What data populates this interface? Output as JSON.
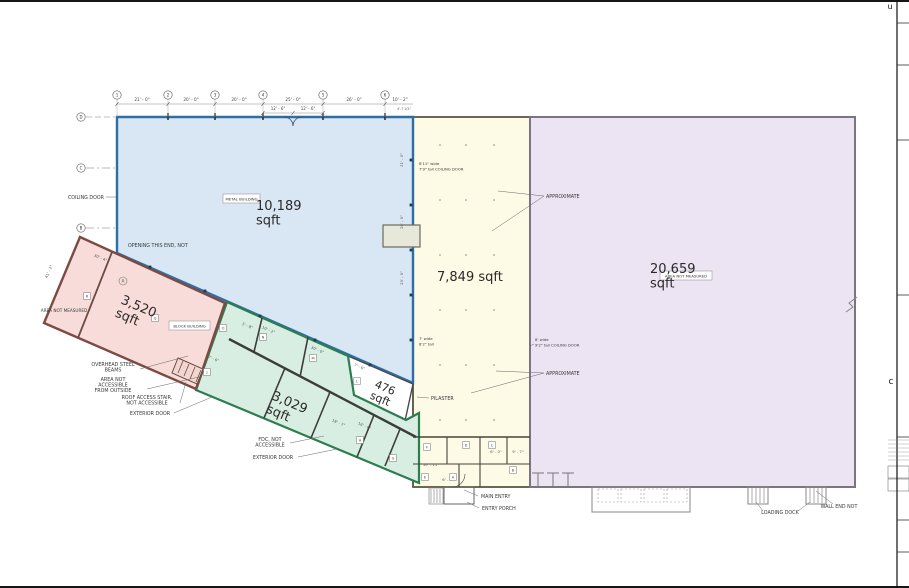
{
  "page": {
    "width": 909,
    "height": 588,
    "bg": "#ffffff",
    "border_color": "#161616"
  },
  "sheet_frame": {
    "line_x": 897,
    "ticks_y": [
      23,
      65,
      140,
      295,
      437,
      520,
      552
    ],
    "table_lines_y": [
      440,
      444,
      448,
      452,
      456,
      460
    ],
    "edge_letter_top": {
      "text": "u",
      "x": 890,
      "y": 9
    },
    "edge_letter_mid": {
      "text": "c",
      "x": 891,
      "y": 384
    }
  },
  "regions": [
    {
      "id": "warehouse-7849",
      "points": "413,117 530,117 530,487 413,487",
      "fill": "#fdfae6",
      "stroke": "#55543f",
      "sw": 1.8,
      "label": {
        "lines": [
          "7,849  sqft"
        ],
        "x": 437,
        "y": 281,
        "fs": 13,
        "r": 0,
        "a": "start"
      }
    },
    {
      "id": "warehouse-20659",
      "points": "530,117 855,117 855,487 530,487",
      "fill": "#ece3f3",
      "stroke": "#7a7580",
      "sw": 2,
      "label": {
        "lines": [
          "20,659",
          "sqft"
        ],
        "x": 650,
        "y": 273,
        "fs": 13,
        "r": 0,
        "a": "start"
      }
    },
    {
      "id": "metal-building-10189",
      "points": "117,117 413,117 413,383 117,253",
      "fill": "#d9e6f4",
      "stroke": "#2e6ea6",
      "sw": 2.4,
      "label": {
        "lines": [
          "10,189",
          "sqft"
        ],
        "x": 256,
        "y": 210,
        "fs": 13,
        "r": 0,
        "a": "start"
      }
    },
    {
      "id": "area-476",
      "points": "348,356 413,384 405,421 354,396",
      "fill": "#ffffff",
      "stroke": "#4a4a4a",
      "sw": 1.4,
      "label": {
        "lines": [
          "476",
          "sqft"
        ],
        "x": 374,
        "y": 387,
        "fs": 11,
        "r": 23,
        "a": "start"
      }
    },
    {
      "id": "block-building-3029",
      "points": "227,302 348,356 354,395 406,420 419,413 419,483 196,390",
      "fill": "#d8eee2",
      "stroke": "#2e7d51",
      "sw": 2.2,
      "label": {
        "lines": [
          "3,029",
          "sqft"
        ],
        "x": 271,
        "y": 399,
        "fs": 13,
        "r": 23,
        "a": "start"
      }
    },
    {
      "id": "building-3520",
      "points": "80,237 225,303 196,389 44,323",
      "fill": "#f8dcda",
      "stroke": "#7b4b43",
      "sw": 2.4,
      "label": {
        "lines": [
          "3,520",
          "sqft"
        ],
        "x": 120,
        "y": 303,
        "fs": 13,
        "r": 23,
        "a": "start"
      }
    }
  ],
  "boxed_tags": [
    {
      "id": "metal-building-tag",
      "text": "METAL BUILDING",
      "x": 223,
      "y": 194,
      "w": 37,
      "h": 9
    },
    {
      "id": "block-building-tag",
      "text": "BLOCK BUILDING",
      "x": 169,
      "y": 321,
      "w": 41,
      "h": 9
    },
    {
      "id": "area-not-measured-tag",
      "text": "AREA NOT MEASURED",
      "x": 660,
      "y": 271,
      "w": 52,
      "h": 9
    }
  ],
  "annotations": [
    {
      "id": "opening-this-end",
      "lines": [
        "OPENING THIS END, NOT"
      ],
      "x": 128,
      "y": 247,
      "a": "start"
    },
    {
      "id": "coiling-door-left",
      "lines": [
        "COILING DOOR"
      ],
      "x": 104,
      "y": 199,
      "a": "end",
      "leaders": [
        [
          106,
          197,
          116,
          197
        ]
      ]
    },
    {
      "id": "area-not-measured-pink",
      "lines": [
        "AREA NOT MEASURED"
      ],
      "x": 64,
      "y": 312,
      "a": "middle",
      "fs": 4.2
    },
    {
      "id": "overhead-steel-beams",
      "lines": [
        "OVERHEAD STEEL",
        "BEAMS"
      ],
      "x": 113,
      "y": 366,
      "a": "middle",
      "leaders": [
        [
          140,
          369,
          188,
          356
        ]
      ]
    },
    {
      "id": "area-not-accessible",
      "lines": [
        "AREA NOT",
        "ACCESSIBLE",
        "FROM OUTSIDE"
      ],
      "x": 113,
      "y": 381,
      "a": "middle",
      "leaders": [
        [
          147,
          389,
          199,
          377
        ]
      ]
    },
    {
      "id": "roof-access-stair",
      "lines": [
        "ROOF ACCESS STAIR,",
        "NOT ACCESSIBLE"
      ],
      "x": 147,
      "y": 399,
      "a": "middle",
      "leaders": [
        [
          180,
          403,
          186,
          382
        ]
      ]
    },
    {
      "id": "exterior-door-pink",
      "lines": [
        "EXTERIOR DOOR"
      ],
      "x": 150,
      "y": 415,
      "a": "middle",
      "leaders": [
        [
          174,
          413,
          212,
          397
        ]
      ]
    },
    {
      "id": "fdc-not-accessible",
      "lines": [
        "FDC, NOT",
        "ACCESSIBLE"
      ],
      "x": 270,
      "y": 441,
      "a": "middle",
      "leaders": [
        [
          290,
          443,
          324,
          436
        ]
      ]
    },
    {
      "id": "exterior-door-green",
      "lines": [
        "EXTERIOR DOOR"
      ],
      "x": 273,
      "y": 459,
      "a": "middle",
      "leaders": [
        [
          298,
          457,
          337,
          449
        ]
      ]
    },
    {
      "id": "main-entry",
      "lines": [
        "MAIN ENTRY"
      ],
      "x": 481,
      "y": 498,
      "a": "start",
      "leaders": [
        [
          478,
          496,
          464,
          490
        ]
      ]
    },
    {
      "id": "entry-porch",
      "lines": [
        "ENTRY PORCH"
      ],
      "x": 482,
      "y": 510,
      "a": "start",
      "leaders": [
        [
          479,
          508,
          467,
          502
        ]
      ]
    },
    {
      "id": "loading-dock",
      "lines": [
        "LOADING DOCK"
      ],
      "x": 780,
      "y": 514,
      "a": "middle",
      "leaders": [
        [
          763,
          511,
          756,
          502
        ],
        [
          798,
          511,
          810,
          502
        ]
      ]
    },
    {
      "id": "wall-end-not",
      "lines": [
        "WALL END NOT"
      ],
      "x": 839,
      "y": 508,
      "a": "middle",
      "leaders": [
        [
          833,
          504,
          816,
          491
        ]
      ]
    },
    {
      "id": "pilaster",
      "lines": [
        "PILASTER"
      ],
      "x": 431,
      "y": 400,
      "a": "start",
      "leaders": [
        [
          429,
          398,
          417,
          397
        ]
      ]
    },
    {
      "id": "approximate-top",
      "lines": [
        "APPROXIMATE"
      ],
      "x": 546,
      "y": 198,
      "a": "start",
      "leaders": [
        [
          544,
          196,
          498,
          191
        ],
        [
          544,
          196,
          492,
          231
        ]
      ]
    },
    {
      "id": "approximate-bottom",
      "lines": [
        "APPROXIMATE"
      ],
      "x": 546,
      "y": 375,
      "a": "start",
      "leaders": [
        [
          544,
          373,
          496,
          371
        ],
        [
          544,
          373,
          471,
          393
        ]
      ]
    },
    {
      "id": "coiling-door-note-top",
      "lines": [
        "8'11\" wide",
        "7'9\" tall  COILING DOOR"
      ],
      "x": 419,
      "y": 165,
      "a": "start",
      "fs": 3.8
    },
    {
      "id": "door-note-mid",
      "lines": [
        "7' wide",
        "8'2\" tall"
      ],
      "x": 419,
      "y": 340,
      "a": "start",
      "fs": 3.8
    },
    {
      "id": "coiling-door-note-right",
      "lines": [
        "8' wide",
        "9'2\" tall  COILING DOOR"
      ],
      "x": 535,
      "y": 341,
      "a": "start",
      "fs": 3.8,
      "leaders": [
        [
          534,
          344,
          530,
          346
        ]
      ]
    }
  ],
  "top_dims": {
    "line_y": 104,
    "line_x1": 117,
    "line_x2": 413,
    "bubbles": [
      {
        "n": "1",
        "x": 117
      },
      {
        "n": "2",
        "x": 168
      },
      {
        "n": "3",
        "x": 215
      },
      {
        "n": "4",
        "x": 263
      },
      {
        "n": "5",
        "x": 323
      },
      {
        "n": "6",
        "x": 385
      }
    ],
    "bubble_y": 95,
    "labels": [
      {
        "text": "21' - 0\"",
        "x": 142
      },
      {
        "text": "20' - 0\"",
        "x": 191
      },
      {
        "text": "20' - 0\"",
        "x": 239
      },
      {
        "text": "25' - 0\"",
        "x": 293
      },
      {
        "text": "26' - 0\"",
        "x": 354
      },
      {
        "text": "10' - 2\"",
        "x": 400
      }
    ],
    "label_y": 101,
    "sub_line": {
      "y": 113,
      "x1": 263,
      "x2": 323,
      "labels": [
        {
          "text": "12' - 6\"",
          "x": 278
        },
        {
          "text": "12' - 6\"",
          "x": 308
        }
      ],
      "label_y": 110
    },
    "tiny_dim": {
      "text": "4'-7 1/2\"",
      "x": 404,
      "y": 110
    }
  },
  "left_grid": {
    "bubbles": [
      {
        "n": "D",
        "y": 117
      },
      {
        "n": "C",
        "y": 168
      },
      {
        "n": "B",
        "y": 228
      }
    ],
    "x": 81,
    "pink_bubble": {
      "n": "A",
      "x": 123,
      "y": 281
    }
  },
  "rot_dims": [
    {
      "t": "21' - 0\"",
      "x": 403,
      "y": 160,
      "r": -90
    },
    {
      "t": "20' - 0\"",
      "x": 403,
      "y": 222,
      "r": -90
    },
    {
      "t": "23' - 0\"",
      "x": 403,
      "y": 278,
      "r": -90
    },
    {
      "t": "30' - 4\"",
      "x": 100,
      "y": 259,
      "r": 23
    },
    {
      "t": "41' - 2\"",
      "x": 50,
      "y": 272,
      "r": -67
    },
    {
      "t": "30' - 0\"",
      "x": 317,
      "y": 351,
      "r": 23
    },
    {
      "t": "5' - 8\"",
      "x": 247,
      "y": 327,
      "r": 23
    },
    {
      "t": "10' - 2\"",
      "x": 268,
      "y": 331,
      "r": 23
    },
    {
      "t": "7' - 6\"",
      "x": 213,
      "y": 360,
      "r": 23
    },
    {
      "t": "7' - 6\"",
      "x": 359,
      "y": 368,
      "r": 23
    },
    {
      "t": "18' - 7\"",
      "x": 338,
      "y": 424,
      "r": 23
    },
    {
      "t": "16' - 6\"",
      "x": 364,
      "y": 427,
      "r": 23
    },
    {
      "t": "6' - 0\"",
      "x": 496,
      "y": 453,
      "r": 0
    },
    {
      "t": "9' - 7\"",
      "x": 518,
      "y": 453,
      "r": 0
    },
    {
      "t": "10' - 11\"",
      "x": 431,
      "y": 466,
      "r": 0
    },
    {
      "t": "6' - 4\"",
      "x": 448,
      "y": 481,
      "r": 0
    }
  ],
  "room_tags": [
    {
      "l": "R",
      "x": 87,
      "y": 296
    },
    {
      "l": "Q",
      "x": 155,
      "y": 318
    },
    {
      "l": "O",
      "x": 223,
      "y": 328
    },
    {
      "l": "N",
      "x": 263,
      "y": 337
    },
    {
      "l": "M",
      "x": 313,
      "y": 358
    },
    {
      "l": "L",
      "x": 357,
      "y": 381
    },
    {
      "l": "J",
      "x": 207,
      "y": 372
    },
    {
      "l": "H",
      "x": 360,
      "y": 440
    },
    {
      "l": "G",
      "x": 393,
      "y": 458
    },
    {
      "l": "F",
      "x": 427,
      "y": 447
    },
    {
      "l": "E",
      "x": 425,
      "y": 477
    },
    {
      "l": "D",
      "x": 466,
      "y": 445
    },
    {
      "l": "C",
      "x": 492,
      "y": 445
    },
    {
      "l": "B",
      "x": 513,
      "y": 470
    },
    {
      "l": "A",
      "x": 453,
      "y": 477
    }
  ],
  "walls": [
    {
      "p": "413,437,530,437",
      "w": 1.6,
      "c": "#45443a"
    },
    {
      "p": "447,437,447,464",
      "w": 1.1,
      "c": "#45443a"
    },
    {
      "p": "480,437,480,487",
      "w": 1.1,
      "c": "#45443a"
    },
    {
      "p": "507,437,507,464",
      "w": 1.1,
      "c": "#45443a"
    },
    {
      "p": "459,464,459,487",
      "w": 1.1,
      "c": "#45443a"
    },
    {
      "p": "413,464,530,464",
      "w": 1.1,
      "c": "#45443a"
    },
    {
      "p": "229,339,416,437",
      "w": 2.4,
      "c": "#3c3c38"
    },
    {
      "p": "262,318,254,352",
      "w": 1.6,
      "c": "#3c3c38"
    },
    {
      "p": "308,337,300,377",
      "w": 1.6,
      "c": "#3c3c38"
    },
    {
      "p": "285,368,264,418",
      "w": 1.6,
      "c": "#3c3c38"
    },
    {
      "p": "330,392,311,438",
      "w": 1.6,
      "c": "#3c3c38"
    },
    {
      "p": "374,415,357,457",
      "w": 1.6,
      "c": "#3c3c38"
    },
    {
      "p": "400,429,385,466",
      "w": 1.6,
      "c": "#3c3c38"
    },
    {
      "p": "112,252,78,338",
      "w": 1.8,
      "c": "#6d4a42"
    },
    {
      "p": "168,113,168,120",
      "w": 1.6,
      "c": "#333333"
    },
    {
      "p": "215,113,215,120",
      "w": 1.6,
      "c": "#333333"
    },
    {
      "p": "263,113,263,120",
      "w": 1.6,
      "c": "#333333"
    },
    {
      "p": "323,113,323,120",
      "w": 1.6,
      "c": "#333333"
    },
    {
      "p": "385,113,385,120",
      "w": 1.6,
      "c": "#333333"
    },
    {
      "p": "538,487,538,473",
      "w": 1,
      "c": "#777777"
    },
    {
      "p": "532,473,544,473",
      "w": 1,
      "c": "#777777"
    },
    {
      "p": "553,487,553,473",
      "w": 1,
      "c": "#777777"
    },
    {
      "p": "547,473,559,473",
      "w": 1,
      "c": "#777777"
    },
    {
      "p": "568,487,568,473",
      "w": 1,
      "c": "#777777"
    },
    {
      "p": "562,473,574,473",
      "w": 1,
      "c": "#777777"
    },
    {
      "p": "752,488,752,503",
      "w": 0.7,
      "c": "#888888"
    },
    {
      "p": "756,488,756,503",
      "w": 0.7,
      "c": "#888888"
    },
    {
      "p": "760,488,760,503",
      "w": 0.7,
      "c": "#888888"
    },
    {
      "p": "764,488,764,503",
      "w": 0.7,
      "c": "#888888"
    },
    {
      "p": "810,488,810,503",
      "w": 0.7,
      "c": "#888888"
    },
    {
      "p": "814,488,814,503",
      "w": 0.7,
      "c": "#888888"
    },
    {
      "p": "818,488,818,503",
      "w": 0.7,
      "c": "#888888"
    },
    {
      "p": "822,488,822,503",
      "w": 0.7,
      "c": "#888888"
    },
    {
      "p": "431,489,431,503",
      "w": 0.7,
      "c": "#888888"
    },
    {
      "p": "434,489,434,503",
      "w": 0.7,
      "c": "#888888"
    },
    {
      "p": "437,489,437,503",
      "w": 0.7,
      "c": "#888888"
    },
    {
      "p": "440,489,440,503",
      "w": 0.7,
      "c": "#888888"
    },
    {
      "p": "183,361,178,373",
      "w": 0.8,
      "c": "#6d4a42"
    },
    {
      "p": "189,364,184,376",
      "w": 0.8,
      "c": "#6d4a42"
    },
    {
      "p": "195,367,190,379",
      "w": 0.8,
      "c": "#6d4a42"
    },
    {
      "p": "201,370,196,382",
      "w": 0.8,
      "c": "#6d4a42"
    }
  ],
  "dashes": [
    {
      "p": "168,119,168,276",
      "c": "#9db0c4",
      "w": 0.7,
      "d": "5 4"
    },
    {
      "p": "215,119,215,297",
      "c": "#9db0c4",
      "w": 0.7,
      "d": "5 4"
    },
    {
      "p": "263,119,263,318",
      "c": "#9db0c4",
      "w": 0.7,
      "d": "5 4"
    },
    {
      "p": "323,119,323,345",
      "c": "#9db0c4",
      "w": 0.7,
      "d": "5 4"
    },
    {
      "p": "385,119,385,373",
      "c": "#9db0c4",
      "w": 0.7,
      "d": "5 4"
    },
    {
      "p": "86,168,411,168",
      "c": "#9aa5ae",
      "w": 0.7,
      "d": "8 3 2 3"
    },
    {
      "p": "86,228,411,228",
      "c": "#9aa5ae",
      "w": 0.7,
      "d": "8 3 2 3"
    },
    {
      "p": "86,117,115,117",
      "c": "#aaaaaa",
      "w": 0.7,
      "d": "6 3"
    },
    {
      "p": "470,120,470,484",
      "c": "#b5ad8c",
      "w": 0.8,
      "d": "9 3 2 3"
    },
    {
      "p": "150,268,116,354",
      "c": "#c49a90",
      "w": 0.8,
      "d": "4 3"
    },
    {
      "p": "178,281,144,367",
      "c": "#c49a90",
      "w": 0.8,
      "d": "4 3"
    }
  ],
  "rects": [
    {
      "x": 383,
      "y": 225,
      "w": 37,
      "h": 22,
      "s": "#6b6b5a",
      "f": "#e8e8da",
      "sw": 1.2
    },
    {
      "x": 592,
      "y": 487,
      "w": 98,
      "h": 25,
      "s": "#8a8a8a",
      "f": "none",
      "sw": 1
    },
    {
      "x": 598,
      "y": 489,
      "w": 20,
      "h": 13,
      "s": "#999999",
      "f": "none",
      "sw": 0.6,
      "d": "2 2"
    },
    {
      "x": 621,
      "y": 489,
      "w": 20,
      "h": 13,
      "s": "#999999",
      "f": "none",
      "sw": 0.6,
      "d": "2 2"
    },
    {
      "x": 644,
      "y": 489,
      "w": 20,
      "h": 13,
      "s": "#999999",
      "f": "none",
      "sw": 0.6,
      "d": "2 2"
    },
    {
      "x": 667,
      "y": 489,
      "w": 20,
      "h": 13,
      "s": "#999999",
      "f": "none",
      "sw": 0.6,
      "d": "2 2"
    },
    {
      "x": 444,
      "y": 487,
      "w": 30,
      "h": 17,
      "s": "#666666",
      "f": "none",
      "sw": 1
    },
    {
      "x": 429,
      "y": 488,
      "w": 14,
      "h": 16,
      "s": "#888888",
      "f": "none",
      "sw": 0.7
    },
    {
      "x": 748,
      "y": 487,
      "w": 20,
      "h": 17,
      "s": "#888888",
      "f": "none",
      "sw": 1
    },
    {
      "x": 806,
      "y": 487,
      "w": 20,
      "h": 17,
      "s": "#888888",
      "f": "none",
      "sw": 1
    },
    {
      "x": 888,
      "y": 466,
      "w": 21,
      "h": 12,
      "s": "#777777",
      "f": "none",
      "sw": 0.6
    },
    {
      "x": 888,
      "y": 479,
      "w": 21,
      "h": 12,
      "s": "#777777",
      "f": "none",
      "sw": 0.6
    }
  ],
  "paths": [
    {
      "d": "M284 117 A9 9 0 0 1 293 126",
      "s": "#33506e",
      "w": 0.8,
      "name": "door-arc-left"
    },
    {
      "d": "M302 117 A9 9 0 0 0 293 126",
      "s": "#33506e",
      "w": 0.8,
      "name": "door-arc-right"
    },
    {
      "d": "M452 487 A13 13 0 0 0 465 474",
      "s": "#555555",
      "w": 0.7,
      "name": "entry-door-arc"
    },
    {
      "d": "M846 312 l7 -5 l-4 -4 l8 -6",
      "s": "#888888",
      "w": 1,
      "name": "wall-break-mark"
    },
    {
      "d": "M178 358 L203 369 L197 384 L172 373 Z",
      "s": "#6d4a42",
      "w": 1,
      "f": "#f3d5d2",
      "name": "stair"
    }
  ],
  "column_marks": {
    "squares": [
      [
        150,
        267
      ],
      [
        205,
        291
      ],
      [
        260,
        316
      ],
      [
        315,
        340
      ],
      [
        370,
        365
      ],
      [
        411,
        160
      ],
      [
        411,
        205
      ],
      [
        411,
        250
      ],
      [
        411,
        295
      ],
      [
        411,
        340
      ]
    ],
    "dots_xs": [
      440,
      466,
      494
    ],
    "dots_ys": [
      145,
      200,
      255,
      310,
      365,
      420
    ]
  }
}
